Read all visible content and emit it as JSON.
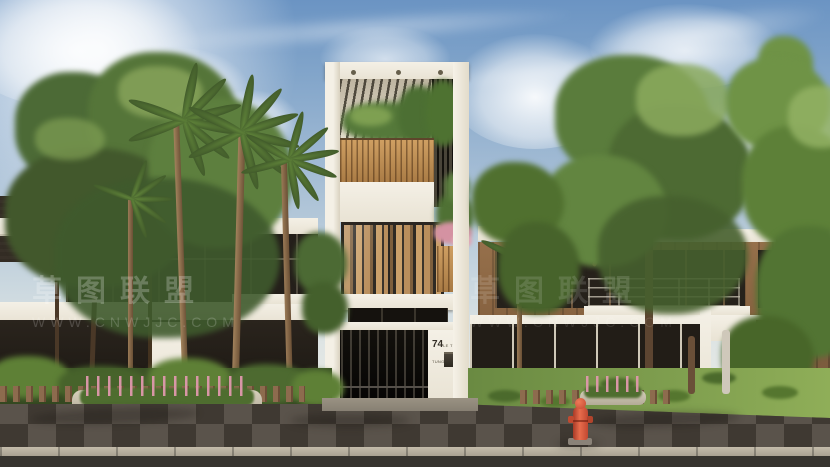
{
  "meta": {
    "alt": "Photorealistic exterior rendering of a narrow four-storey modern townhouse with wood-slat planters and pergola, flanked by two neighbouring villas, pine and palm trees, paved sidewalk, planting beds and a red fire hydrant.",
    "canvas": {
      "width": 830,
      "height": 467
    }
  },
  "watermark": {
    "line_cn": "草图联盟",
    "line_url": "WWW.CNWJJC.COM"
  },
  "house": {
    "number": "74",
    "street_label": "LE TRONG TUNG"
  },
  "palette": {
    "sky_top": "#6b94c3",
    "sky_horizon": "#ece9e1",
    "foliage_dark": "#3f5a2d",
    "foliage_mid": "#5d7f3e",
    "foliage_light": "#8aa85c",
    "wall_white": "#f1ece1",
    "wood_slat": "#b58352",
    "glass_dark": "#211d18",
    "pavement": "#57504a",
    "pavement_tile_dark": "#3f3932",
    "curb": "#a69e8f",
    "road": "#37342f",
    "hydrant_red": "#d95a3c",
    "flower_pink": "#d992a2",
    "lawn_green": "#7d9c4e"
  }
}
